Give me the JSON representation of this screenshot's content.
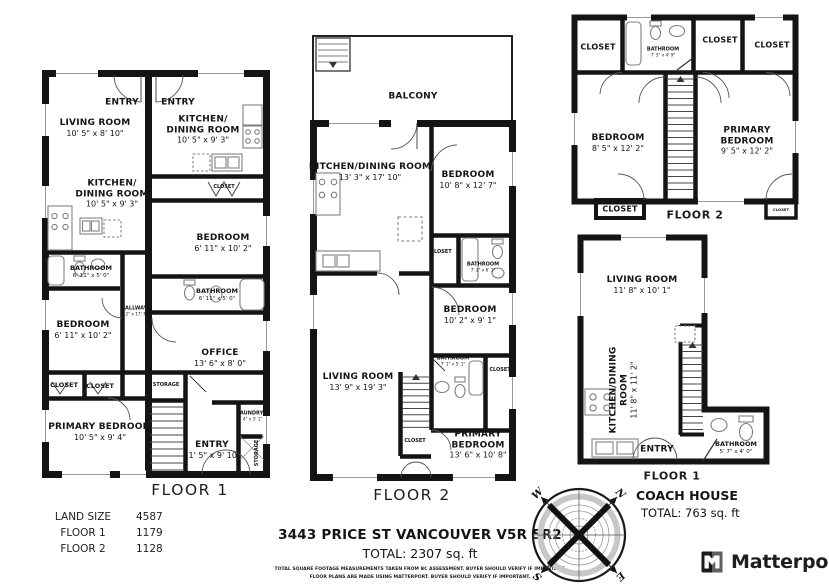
{
  "plans": {
    "main_floor1": {
      "caption": "FLOOR 1",
      "rooms": {
        "entry_left": {
          "name": "ENTRY"
        },
        "living_room": {
          "name": "LIVING ROOM",
          "dims": "10' 5\" x 8' 10\""
        },
        "kitchen_left": {
          "name": "KITCHEN/",
          "name2": "DINING ROOM",
          "dims": "10' 5\" x 9' 3\""
        },
        "entry_right": {
          "name": "ENTRY"
        },
        "kitchen_right": {
          "name": "KITCHEN/",
          "name2": "DINING ROOM",
          "dims": "10' 5\" x 9' 3\""
        },
        "closet_right": {
          "name": "CLOSET"
        },
        "bedroom_right": {
          "name": "BEDROOM",
          "dims": "6' 11\" x 10' 2\""
        },
        "bathroom_left": {
          "name": "BATHROOM",
          "dims": "6' 11\" x 5' 0\""
        },
        "bathroom_right": {
          "name": "BATHROOM",
          "dims": "6' 11\" x 5' 0\""
        },
        "bedroom_left": {
          "name": "BEDROOM",
          "dims": "6' 11\" x 10' 2\""
        },
        "hallway": {
          "name": "HALLWAY",
          "dims": "3' 2\" x 17' 7\""
        },
        "office": {
          "name": "OFFICE",
          "dims": "13' 6\" x 8' 0\""
        },
        "closet_a": {
          "name": "CLOSET"
        },
        "closet_b": {
          "name": "CLOSET"
        },
        "storage_small": {
          "name": "STORAGE"
        },
        "primary_bedroom": {
          "name": "PRIMARY BEDROOM",
          "dims": "10' 5\" x 9' 4\""
        },
        "laundry": {
          "name": "LAUNDRY",
          "dims": "2' 4\" x 3' 1\""
        },
        "entry_bottom": {
          "name": "ENTRY",
          "dims": "11' 5\" x 9' 10\""
        },
        "storage_vert": {
          "name": "STORAGE"
        }
      }
    },
    "main_floor2": {
      "caption": "FLOOR 2",
      "rooms": {
        "balcony": {
          "name": "BALCONY"
        },
        "kitchen_dining": {
          "name": "KITCHEN/DINING ROOM",
          "dims": "13' 3\" x 17' 10\""
        },
        "bedroom_top": {
          "name": "BEDROOM",
          "dims": "10' 8\" x 12' 7\""
        },
        "closet_mid": {
          "name": "CLOSET"
        },
        "bathroom_top": {
          "name": "BATHROOM",
          "dims": "7' 2\" x 6' 1\""
        },
        "bedroom_mid": {
          "name": "BEDROOM",
          "dims": "10' 2\" x 9' 1\""
        },
        "bathroom_mid": {
          "name": "BATHROOM",
          "dims": "7' 1\" x 5' 1\""
        },
        "closet_right": {
          "name": "CLOSET"
        },
        "living_room": {
          "name": "LIVING ROOM",
          "dims": "13' 9\" x 19' 3\""
        },
        "closet_stairs": {
          "name": "CLOSET"
        },
        "primary_bedroom": {
          "name": "PRIMARY",
          "name2": "BEDROOM",
          "dims": "13' 6\" x 10' 8\""
        }
      }
    },
    "coach_floor2": {
      "caption": "FLOOR 2",
      "rooms": {
        "closet_tl": {
          "name": "CLOSET"
        },
        "bathroom": {
          "name": "BATHROOM",
          "dims": "7' 5\" x 4' 9\""
        },
        "closet_tm": {
          "name": "CLOSET"
        },
        "closet_tr": {
          "name": "CLOSET"
        },
        "bedroom": {
          "name": "BEDROOM",
          "dims": "8' 5\" x 12' 2\""
        },
        "primary_bedroom": {
          "name": "PRIMARY",
          "name2": "BEDROOM",
          "dims": "9' 5\" x 12' 2\""
        },
        "closet_bl": {
          "name": "CLOSET"
        },
        "closet_br": {
          "name": "CLOSET"
        }
      }
    },
    "coach_floor1": {
      "caption": "FLOOR 1",
      "rooms": {
        "living_room": {
          "name": "LIVING ROOM",
          "dims": "11' 8\" x 10' 1\""
        },
        "kitchen_dining": {
          "name": "KITCHEN/DINING",
          "name2": "ROOM",
          "dims": "11' 8\" x 11' 2\""
        },
        "entry": {
          "name": "ENTRY"
        },
        "bathroom": {
          "name": "BATHROOM",
          "dims": "5' 7\" x 4' 0\""
        }
      }
    }
  },
  "stats": {
    "rows": [
      {
        "label": "LAND SIZE",
        "value": "4587"
      },
      {
        "label": "FLOOR 1",
        "value": "1179"
      },
      {
        "label": "FLOOR 2",
        "value": "1128"
      }
    ]
  },
  "address": {
    "line1": "3443 PRICE ST VANCOUVER V5R 5R2",
    "total": "TOTAL: 2307 sq. ft",
    "disclaimer1": "TOTAL SQUARE FOOTAGE MEASUREMENTS TAKEN FROM BC ASSESSMENT. BUYER SHOULD VERIFY IF IMPORTANT.",
    "disclaimer2": "FLOOR PLANS ARE MADE USING MATTERPORT. BUYER SHOULD VERIFY IF IMPORTANT."
  },
  "coach_house": {
    "title": "COACH HOUSE",
    "total": "TOTAL: 763 sq. ft"
  },
  "compass": {
    "n": "N",
    "e": "E",
    "s": "S",
    "w": "W"
  },
  "branding": {
    "logo_text": "Matterport"
  },
  "colors": {
    "wall": "#141414",
    "fixture": "#808080",
    "text": "#1a1a1a"
  }
}
